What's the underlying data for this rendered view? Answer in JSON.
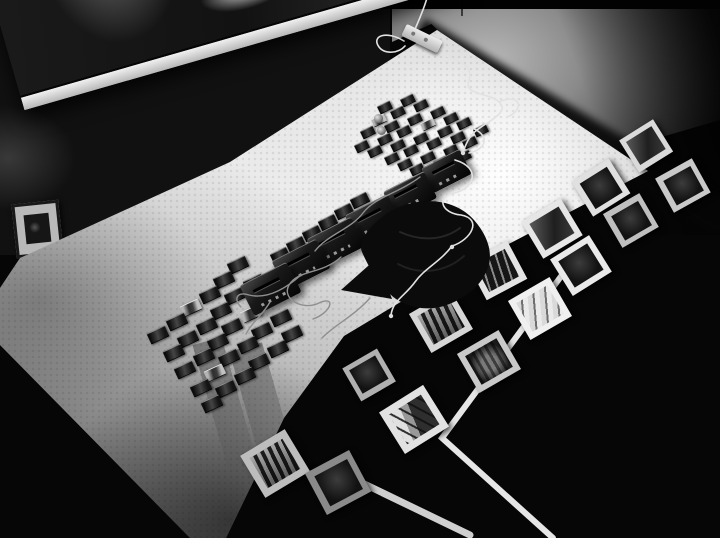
{
  "meta": {
    "description": "Black-and-white photograph of a gallery installation: an illuminated light table covered with mounted film slides, portable cassette players joined by tangled earphone cables and a folded black cloth; white-bordered photographic prints and white tape lines are arranged on the dark floor around the table; a large dark framed artwork and a small framed photo hang on the wall at top left; a white power strip with a cord trails onto the table.",
    "width": 720,
    "height": 538
  },
  "palette": {
    "background": "#060606",
    "table_white": "#efefef",
    "floor_gray": "#b6b6b6",
    "tape_white": "#e6e6e6",
    "cable_white": "#e2e2e2",
    "cable_gray": "#8f8f8f",
    "device_black": "#141414",
    "print_border": "#e6e6e6"
  },
  "scene": {
    "photos": [
      {
        "x": 646,
        "y": 146,
        "s": 40,
        "r": -32,
        "tone": "#dadada",
        "v": "mid"
      },
      {
        "x": 683,
        "y": 186,
        "s": 42,
        "r": -29,
        "tone": "#c9c9c9",
        "v": "dark"
      },
      {
        "x": 601,
        "y": 188,
        "s": 44,
        "r": -32,
        "tone": "#e0e0e0",
        "v": "dark"
      },
      {
        "x": 552,
        "y": 229,
        "s": 46,
        "r": -31,
        "tone": "#e6e6e6",
        "v": "mid"
      },
      {
        "x": 631,
        "y": 221,
        "s": 42,
        "r": -30,
        "tone": "#bfbfbf",
        "v": "dark"
      },
      {
        "x": 581,
        "y": 266,
        "s": 46,
        "r": -32,
        "tone": "#e9e9e9",
        "v": "dark"
      },
      {
        "x": 540,
        "y": 309,
        "s": 48,
        "r": -30,
        "tone": "#f0f0f0",
        "v": "bright"
      },
      {
        "x": 497,
        "y": 271,
        "s": 46,
        "r": -28,
        "tone": "#e4e4e4",
        "v": "trees"
      },
      {
        "x": 441,
        "y": 322,
        "s": 48,
        "r": -30,
        "tone": "#d6d6d6",
        "v": "blinds"
      },
      {
        "x": 489,
        "y": 362,
        "s": 48,
        "r": -30,
        "tone": "#c9c9c9",
        "v": "teeth"
      },
      {
        "x": 414,
        "y": 419,
        "s": 52,
        "r": -32,
        "tone": "#e2e2e2",
        "v": "pier"
      },
      {
        "x": 369,
        "y": 375,
        "s": 40,
        "r": -30,
        "tone": "#b0b0b0",
        "v": "dark"
      },
      {
        "x": 275,
        "y": 463,
        "s": 52,
        "r": -31,
        "tone": "#bdbdbd",
        "v": "blinds"
      },
      {
        "x": 338,
        "y": 482,
        "s": 50,
        "r": -28,
        "tone": "#8a8a8a",
        "v": "dark"
      }
    ],
    "slide_grids": {
      "upper": {
        "origin": [
          393,
          94
        ],
        "col": [
          14.5,
          6
        ],
        "row": [
          -8,
          13
        ],
        "cols": 7,
        "rows": 5,
        "w": 14,
        "h": 9,
        "rot": -26,
        "skip": [
          [
            0,
            0
          ],
          [
            4,
            5
          ],
          [
            4,
            6
          ],
          [
            3,
            6
          ]
        ],
        "bright": [
          [
            2,
            0
          ],
          [
            1,
            3
          ]
        ]
      },
      "lower": {
        "origin": [
          240,
          266
        ],
        "col": [
          13,
          17
        ],
        "row": [
          -16,
          14
        ],
        "cols": 5,
        "rows": 6,
        "w": 20,
        "h": 12,
        "rot": -25,
        "skip": [],
        "bright": [
          [
            1,
            2
          ],
          [
            3,
            0
          ],
          [
            4,
            3
          ]
        ]
      }
    },
    "slide_extras": [
      [
        360,
        200
      ],
      [
        344,
        211
      ],
      [
        328,
        222
      ],
      [
        312,
        233
      ],
      [
        296,
        244
      ],
      [
        280,
        255
      ]
    ],
    "reels": [
      [
        374,
        114
      ],
      [
        377,
        126
      ]
    ],
    "devices": [
      {
        "x": 447,
        "y": 170,
        "s": 0.9
      },
      {
        "x": 410,
        "y": 194,
        "s": 0.95
      },
      {
        "x": 373,
        "y": 218,
        "s": 1.0
      },
      {
        "x": 336,
        "y": 242,
        "s": 1.05
      },
      {
        "x": 301,
        "y": 264,
        "s": 1.05
      },
      {
        "x": 270,
        "y": 288,
        "s": 1.1
      }
    ],
    "streaks": [
      {
        "x": 214,
        "y": 338,
        "w": 30,
        "h": 160,
        "rot": -16
      },
      {
        "x": 250,
        "y": 344,
        "w": 34,
        "h": 155,
        "rot": -16
      }
    ],
    "tape_lines": [
      {
        "points": "576,256 442,438 553,538",
        "w": 6,
        "color": "#e6e6e6"
      },
      {
        "points": "356,480 470,535",
        "w": 7,
        "color": "#cfcfcf"
      }
    ],
    "cloth": {
      "path": "M402,206 C430,196 458,202 474,220 C488,236 494,254 487,270 C480,288 462,300 444,306 C424,312 402,306 390,294 C378,283 368,266 362,252 C356,238 380,214 402,206 Z",
      "flap": "M377,258 L341,290 L392,299 Z",
      "fold1": "M400,232 C422,242 444,240 460,228",
      "fold2": "M398,264 C420,276 446,272 464,256"
    },
    "cables": {
      "white": [
        "M427,-2 C423,12 417,24 413,34",
        "M404,41 C386,30 371,36 379,47 C385,55 399,53 405,46",
        "M433,50 C452,60 475,62 469,80 C463,96 489,92 499,102 C511,112 487,122 477,130 C469,136 466,144 463,152",
        "M499,102 C521,92 525,110 507,117",
        "M455,160 C482,168 474,189 454,193 C436,197 441,213 461,215 C483,219 471,240 452,246",
        "M452,246 C440,262 425,268 415,282 C405,296 393,300 391,315",
        "M470,127 C491,135 487,149 469,153"
      ],
      "gray": [
        "M420,177 C399,193 375,197 363,213 C351,229 327,235 315,251",
        "M341,257 C321,275 299,269 289,285 C281,299 303,311 319,303 C337,295 331,313 313,319",
        "M301,275 C283,291 265,299 249,295 C237,291 233,299 241,307",
        "M270,302 C262,316 252,322 246,334",
        "M370,298 C354,316 336,324 322,338"
      ],
      "earbuds": [
        [
          463,
          153
        ],
        [
          452,
          247
        ],
        [
          391,
          316
        ]
      ]
    },
    "artwork_specks": [
      [
        214,
        128
      ],
      [
        226,
        137
      ]
    ]
  }
}
